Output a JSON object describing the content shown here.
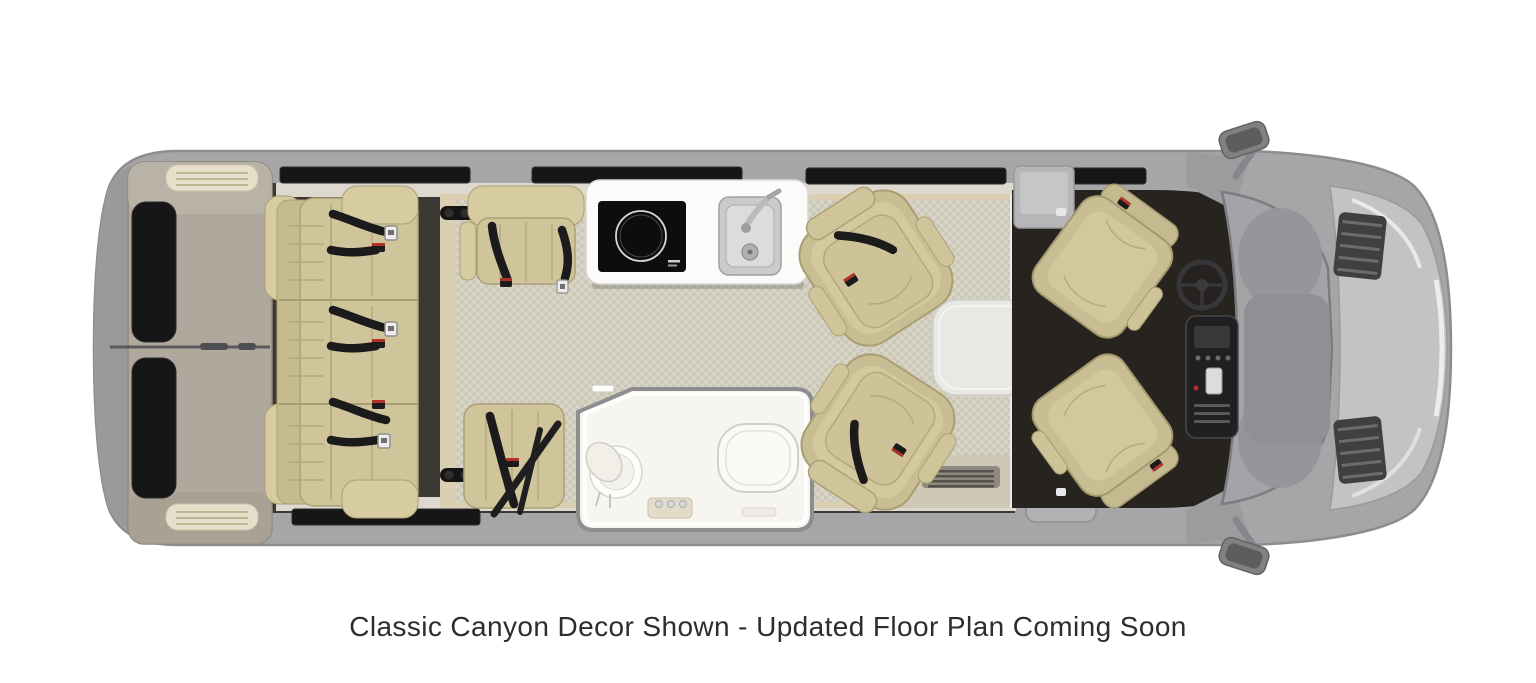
{
  "caption": {
    "text": "Classic Canyon Decor Shown - Updated Floor Plan Coming Soon"
  },
  "palette": {
    "body_gray": "#a6a6a9",
    "body_outline": "#8d8d90",
    "door_taupe": "#b0a89c",
    "window_dark": "#161616",
    "interior_dark": "#3c3833",
    "floor_wood": "#dbcfb2",
    "floor_weave": "#d7d3c5",
    "trim_light": "#ddd9cf",
    "threshold_light": "#eceae4",
    "seat_tan": "#cfc49a",
    "seat_tan_light": "#d6cba1",
    "seat_tan_dark": "#c6bb90",
    "seat_outline": "#aba076",
    "belt_black": "#1b1b1b",
    "buckle_silver": "#ececec",
    "accent_red": "#b23228",
    "galley_white": "#fbfbf9",
    "cooktop_black": "#0d0d0d",
    "sink_steel": "#c9cbcd",
    "bath_white": "#f6f5f0",
    "table_white": "#e8e8e5",
    "cab_floor": "#27231f",
    "dash_dark": "#202022",
    "windshield_gray": "#a2a4a7",
    "cowl_gray": "#8e9093",
    "hood_gray": "#c2c3c5",
    "vent_dark": "#3f4042",
    "mirror_gray": "#808183",
    "caption_color": "#2d2d2d"
  },
  "items": [
    "rear-doors",
    "rear-sofa",
    "lounge-chair-galley-side",
    "lounge-chair-bath-side",
    "galley-counter",
    "induction-cooktop",
    "kitchen-sink",
    "faucet",
    "bathroom",
    "toilet",
    "shower",
    "pedestal-table",
    "swivel-chair-top",
    "swivel-chair-bottom",
    "driver-seat",
    "passenger-seat",
    "steering-wheel",
    "center-console",
    "entry-step",
    "side-mirror-driver",
    "side-mirror-passenger"
  ]
}
